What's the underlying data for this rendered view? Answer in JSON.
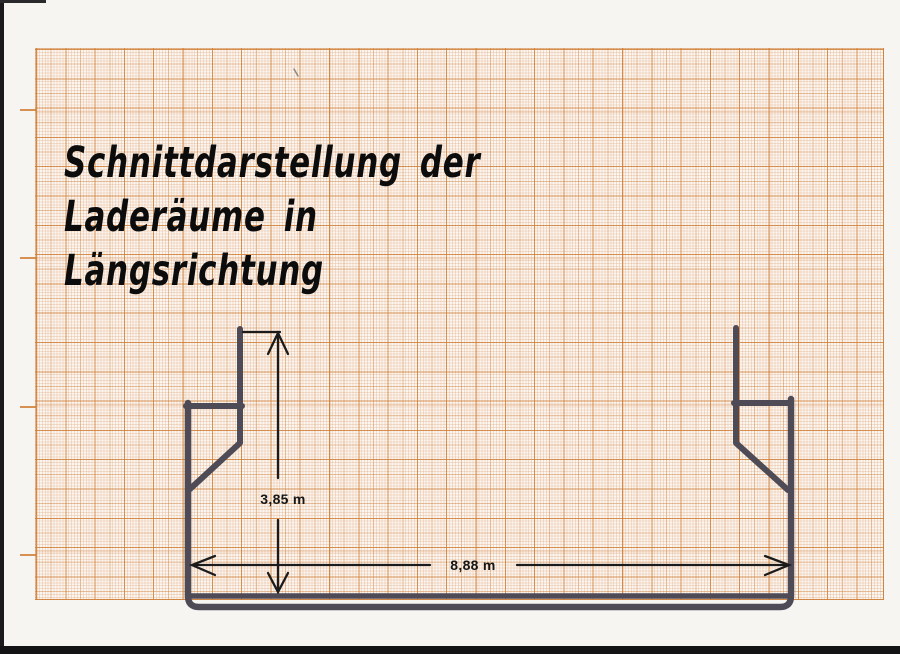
{
  "document": {
    "title_lines": [
      "Schnittdarstellung der",
      "Laderäume in",
      "Längsrichtung"
    ]
  },
  "drawing": {
    "height_dimension": "3,85 m",
    "width_dimension": "8,88 m"
  },
  "colors": {
    "paper": "#f7f5f2",
    "grid_background": "#fcf6f1",
    "grid_major_line": "#cf7e36",
    "grid_medium_line": "#d59154",
    "grid_fine_line": "#dda67a",
    "hull_line": "#4e4a56",
    "dimension_line": "#1b1b1b",
    "title_color": "#0c0c0c",
    "scan_edge": "#141416"
  }
}
